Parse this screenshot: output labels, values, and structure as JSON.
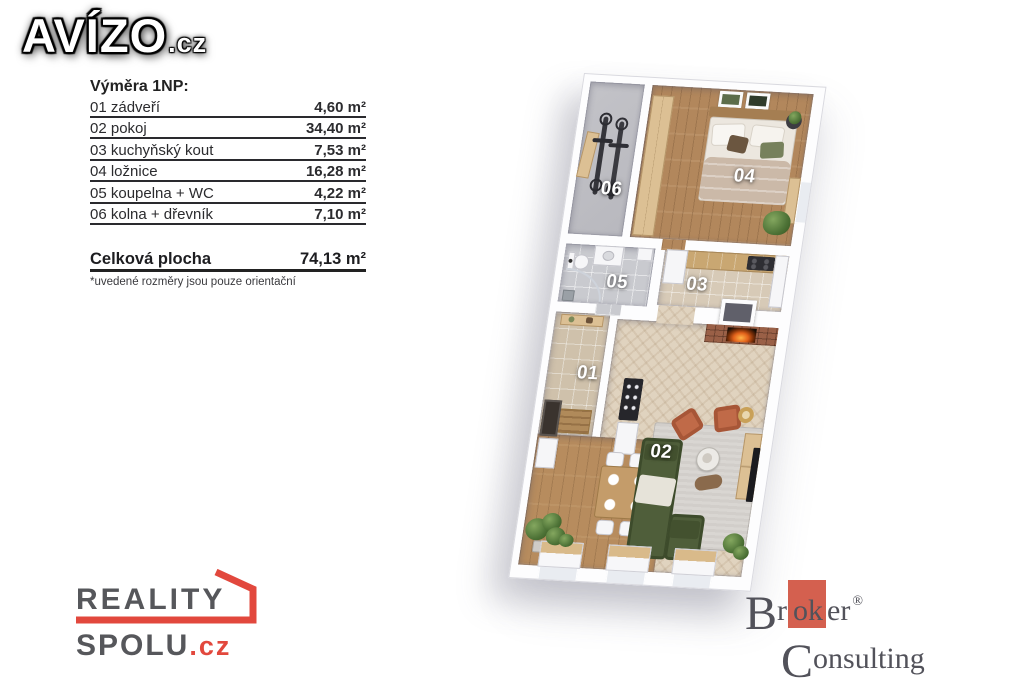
{
  "branding": {
    "avizo": {
      "name": "AVÍZO",
      "tld": ".cz",
      "text_color": "#ffffff",
      "outline_color": "#000000"
    },
    "reality_spolu": {
      "word1": "REALITY",
      "word2": "SPOLU",
      "tld": ".cz",
      "accent_color": "#e2483d",
      "text_color": "#56575b"
    },
    "broker_consulting": {
      "initial1": "B",
      "pre": "r",
      "highlight": "ok",
      "post": "er",
      "reg": "®",
      "initial2": "C",
      "line2_rest": "onsulting",
      "accent_color": "#d4604f",
      "text_color": "#52525a"
    }
  },
  "measurements": {
    "heading": "Výměra 1NP:",
    "rows": [
      {
        "label": "01 zádveří",
        "value": "4,60 m²"
      },
      {
        "label": "02 pokoj",
        "value": "34,40 m²"
      },
      {
        "label": "03 kuchyňský kout",
        "value": "7,53 m²"
      },
      {
        "label": "04 ložnice",
        "value": "16,28 m²"
      },
      {
        "label": "05 koupelna + WC",
        "value": "4,22 m²"
      },
      {
        "label": "06 kolna + dřevník",
        "value": "7,10 m²"
      }
    ],
    "total": {
      "label": "Celková plocha",
      "value": "74,13 m²"
    },
    "disclaimer": "*uvedené rozměry jsou pouze orientační"
  },
  "floorplan": {
    "rooms": [
      {
        "number": "01"
      },
      {
        "number": "02"
      },
      {
        "number": "03"
      },
      {
        "number": "04"
      },
      {
        "number": "05"
      },
      {
        "number": "06"
      }
    ]
  }
}
